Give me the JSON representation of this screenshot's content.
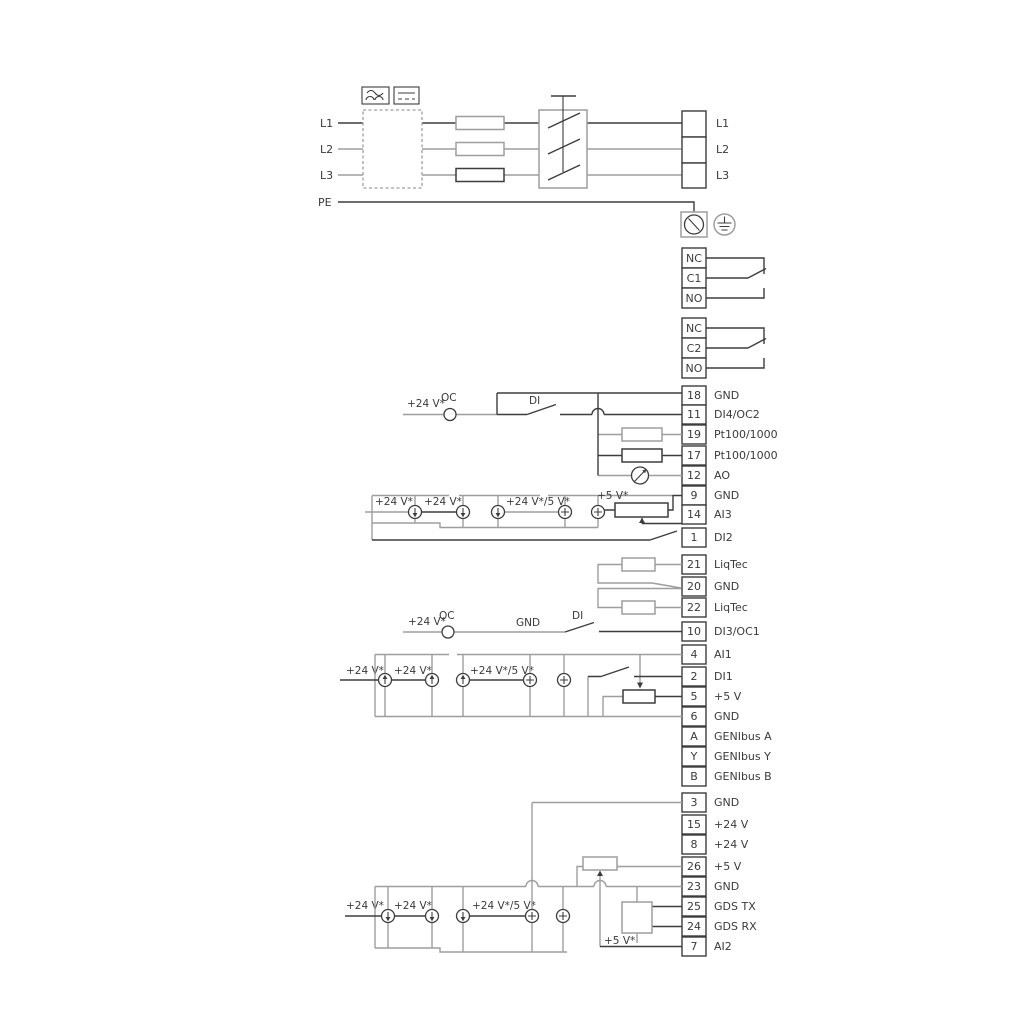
{
  "labels": {
    "v24": "+24 V*",
    "v24_5": "+24 V*/5 V*",
    "v5": "+5 V*",
    "oc": "OC",
    "di": "DI",
    "gnd": "GND"
  },
  "power": {
    "inputs": [
      "L1",
      "L2",
      "L3",
      "PE"
    ],
    "outputs": [
      "L1",
      "L2",
      "L3"
    ]
  },
  "relays": {
    "relay1": [
      "NC",
      "C1",
      "NO"
    ],
    "relay2": [
      "NC",
      "C2",
      "NO"
    ]
  },
  "terminals": {
    "io1": [
      {
        "no": "18",
        "label": "GND"
      },
      {
        "no": "11",
        "label": "DI4/OC2"
      },
      {
        "no": "19",
        "label": "Pt100/1000"
      },
      {
        "no": "17",
        "label": "Pt100/1000"
      },
      {
        "no": "12",
        "label": "AO"
      },
      {
        "no": "9",
        "label": "GND"
      },
      {
        "no": "14",
        "label": "AI3"
      },
      {
        "no": "1",
        "label": "DI2"
      }
    ],
    "liqtec": [
      {
        "no": "21",
        "label": "LiqTec"
      },
      {
        "no": "20",
        "label": "GND"
      },
      {
        "no": "22",
        "label": "LiqTec"
      }
    ],
    "di3": [
      {
        "no": "10",
        "label": "DI3/OC1"
      }
    ],
    "analog1": [
      {
        "no": "4",
        "label": "AI1"
      },
      {
        "no": "2",
        "label": "DI1"
      },
      {
        "no": "5",
        "label": "+5 V"
      },
      {
        "no": "6",
        "label": "GND"
      }
    ],
    "genibus": [
      {
        "no": "A",
        "label": "GENIbus A"
      },
      {
        "no": "Y",
        "label": "GENIbus Y"
      },
      {
        "no": "B",
        "label": "GENIbus B"
      }
    ],
    "io2": [
      {
        "no": "3",
        "label": "GND"
      },
      {
        "no": "15",
        "label": "+24 V"
      },
      {
        "no": "8",
        "label": "+24 V"
      },
      {
        "no": "26",
        "label": "+5 V"
      },
      {
        "no": "23",
        "label": "GND"
      },
      {
        "no": "25",
        "label": "GDS TX"
      },
      {
        "no": "24",
        "label": "GDS RX"
      },
      {
        "no": "7",
        "label": "AI2"
      }
    ]
  }
}
